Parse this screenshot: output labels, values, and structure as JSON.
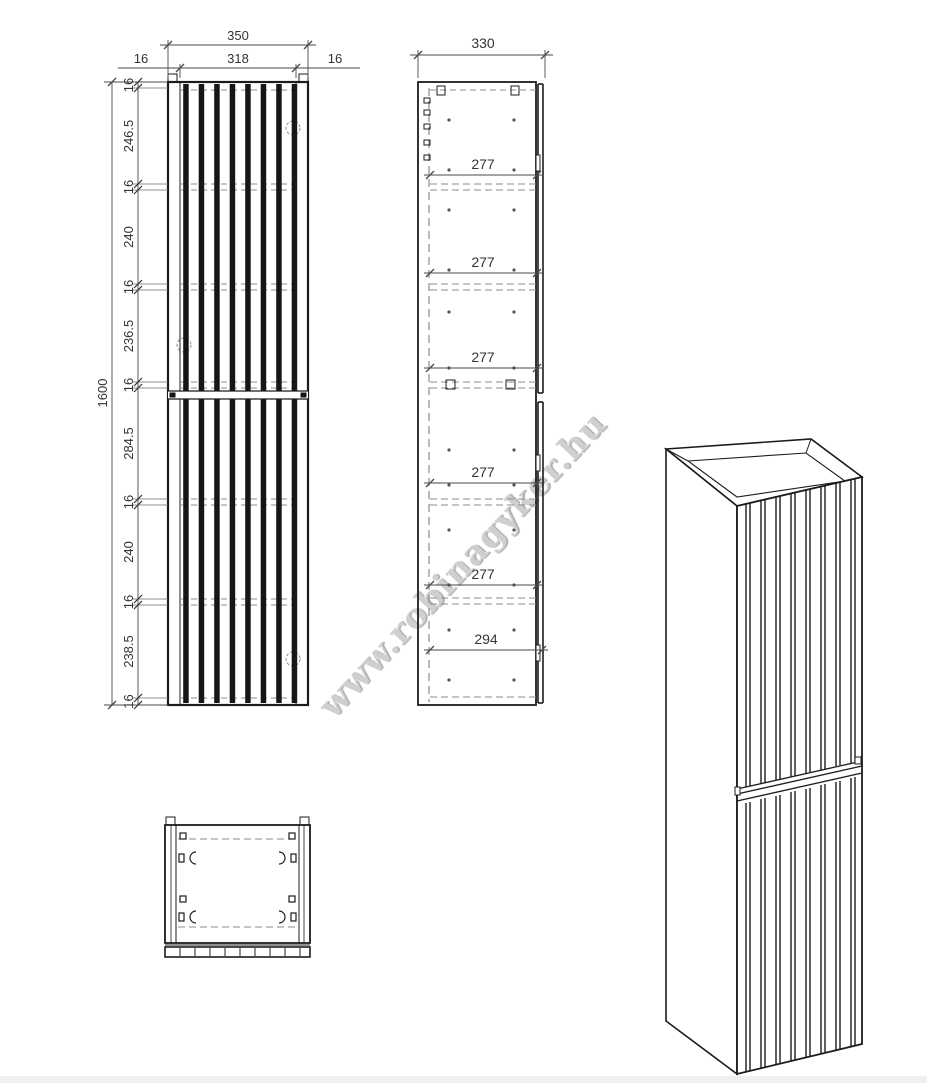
{
  "watermark": {
    "text": "www.robinagyker.hu"
  },
  "front_view": {
    "width_total": "350",
    "width_inner": "318",
    "wall_left": "16",
    "wall_right": "16",
    "height_total": "1600",
    "height_chain": [
      "16",
      "246.5",
      "16",
      "240",
      "16",
      "236.5",
      "16",
      "284.5",
      "16",
      "240",
      "16",
      "238.5",
      "16"
    ]
  },
  "side_view": {
    "depth_total": "330",
    "shelf_depths": [
      "277",
      "277",
      "277",
      "277",
      "277",
      "294"
    ]
  },
  "colors": {
    "line": "#1c1c1c",
    "hidden_line": "#8c8c8c",
    "dim_line": "#4a4a4a",
    "watermark": "#cfcfcf"
  }
}
